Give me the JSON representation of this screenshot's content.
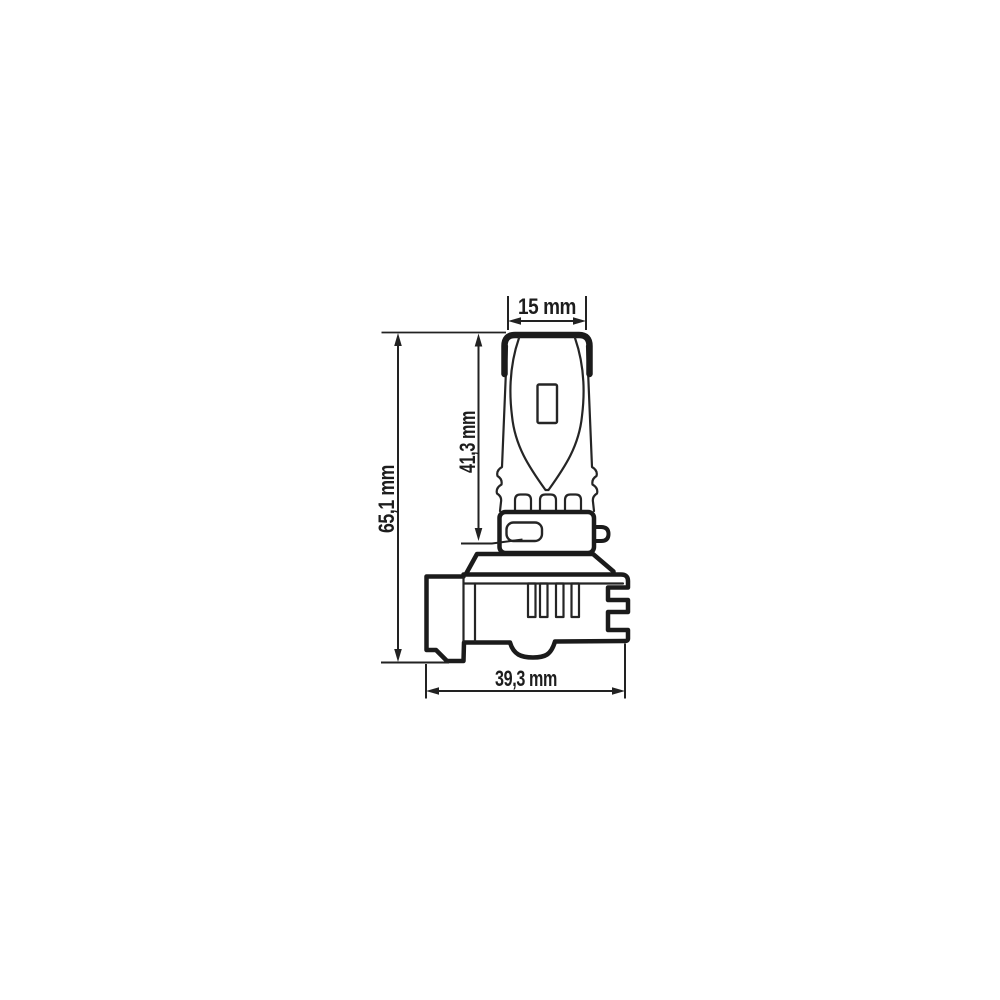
{
  "diagram": {
    "title": "LED bulb dimensional technical drawing",
    "type": "technical-drawing",
    "background_color": "#ffffff",
    "line_color": "#1b1b1b",
    "dimensions": {
      "cap_width": {
        "label": "15 mm",
        "value": 15,
        "unit": "mm"
      },
      "upper_section_height": {
        "label": "41,3 mm",
        "value": 41.3,
        "unit": "mm"
      },
      "overall_height": {
        "label": "65,1 mm",
        "value": 65.1,
        "unit": "mm"
      },
      "base_width": {
        "label": "39,3 mm",
        "value": 39.3,
        "unit": "mm"
      }
    }
  }
}
